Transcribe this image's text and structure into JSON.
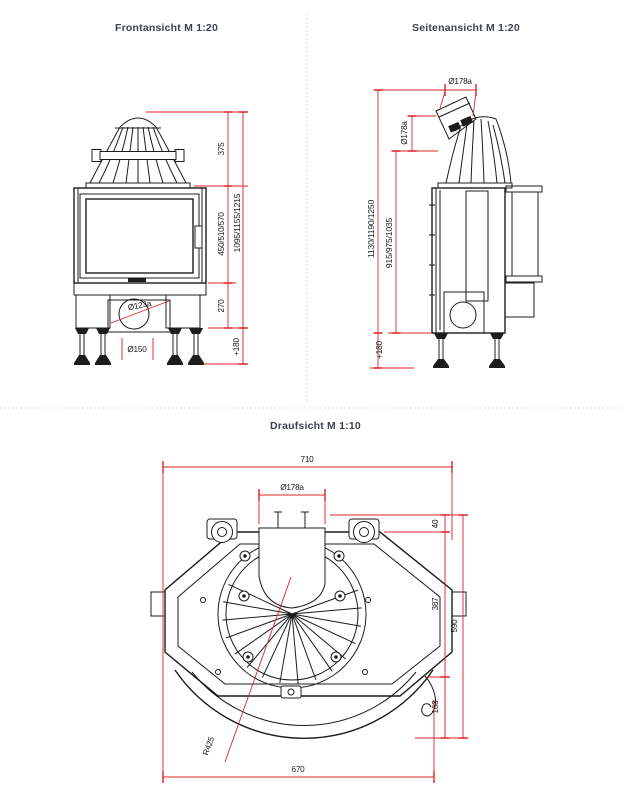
{
  "colors": {
    "line": "#1c1c1c",
    "dimension": "#df2126",
    "title": "#3d434c",
    "divider": "#c9c9c9",
    "background": "#ffffff"
  },
  "front_view": {
    "title": "Frontansicht M 1:20",
    "dims": {
      "dome_height": "375",
      "door_height": "450/510/570",
      "total_height": "1095/1155/1215",
      "plinth_height": "270",
      "feet_height": "+180",
      "air_inlet_diameter": "Ø123a",
      "foot_circle_diameter": "Ø150"
    }
  },
  "side_view": {
    "title": "Seitenansicht M 1:20",
    "dims": {
      "flue_outer_diameter": "Ø178a",
      "flue_outer_diameter_vertical": "Ø178a",
      "total_height": "1130/1190/1250",
      "body_height": "915/975/1035",
      "feet_height": "+180"
    }
  },
  "top_view": {
    "title": "Draufsicht M 1:10",
    "dims": {
      "overall_width": "710",
      "flue_outer_diameter": "Ø178a",
      "rear_depth": "40",
      "mid_depth": "387",
      "overall_depth": "590",
      "front_depth": "163",
      "front_width": "670",
      "door_radius": "R425"
    }
  }
}
